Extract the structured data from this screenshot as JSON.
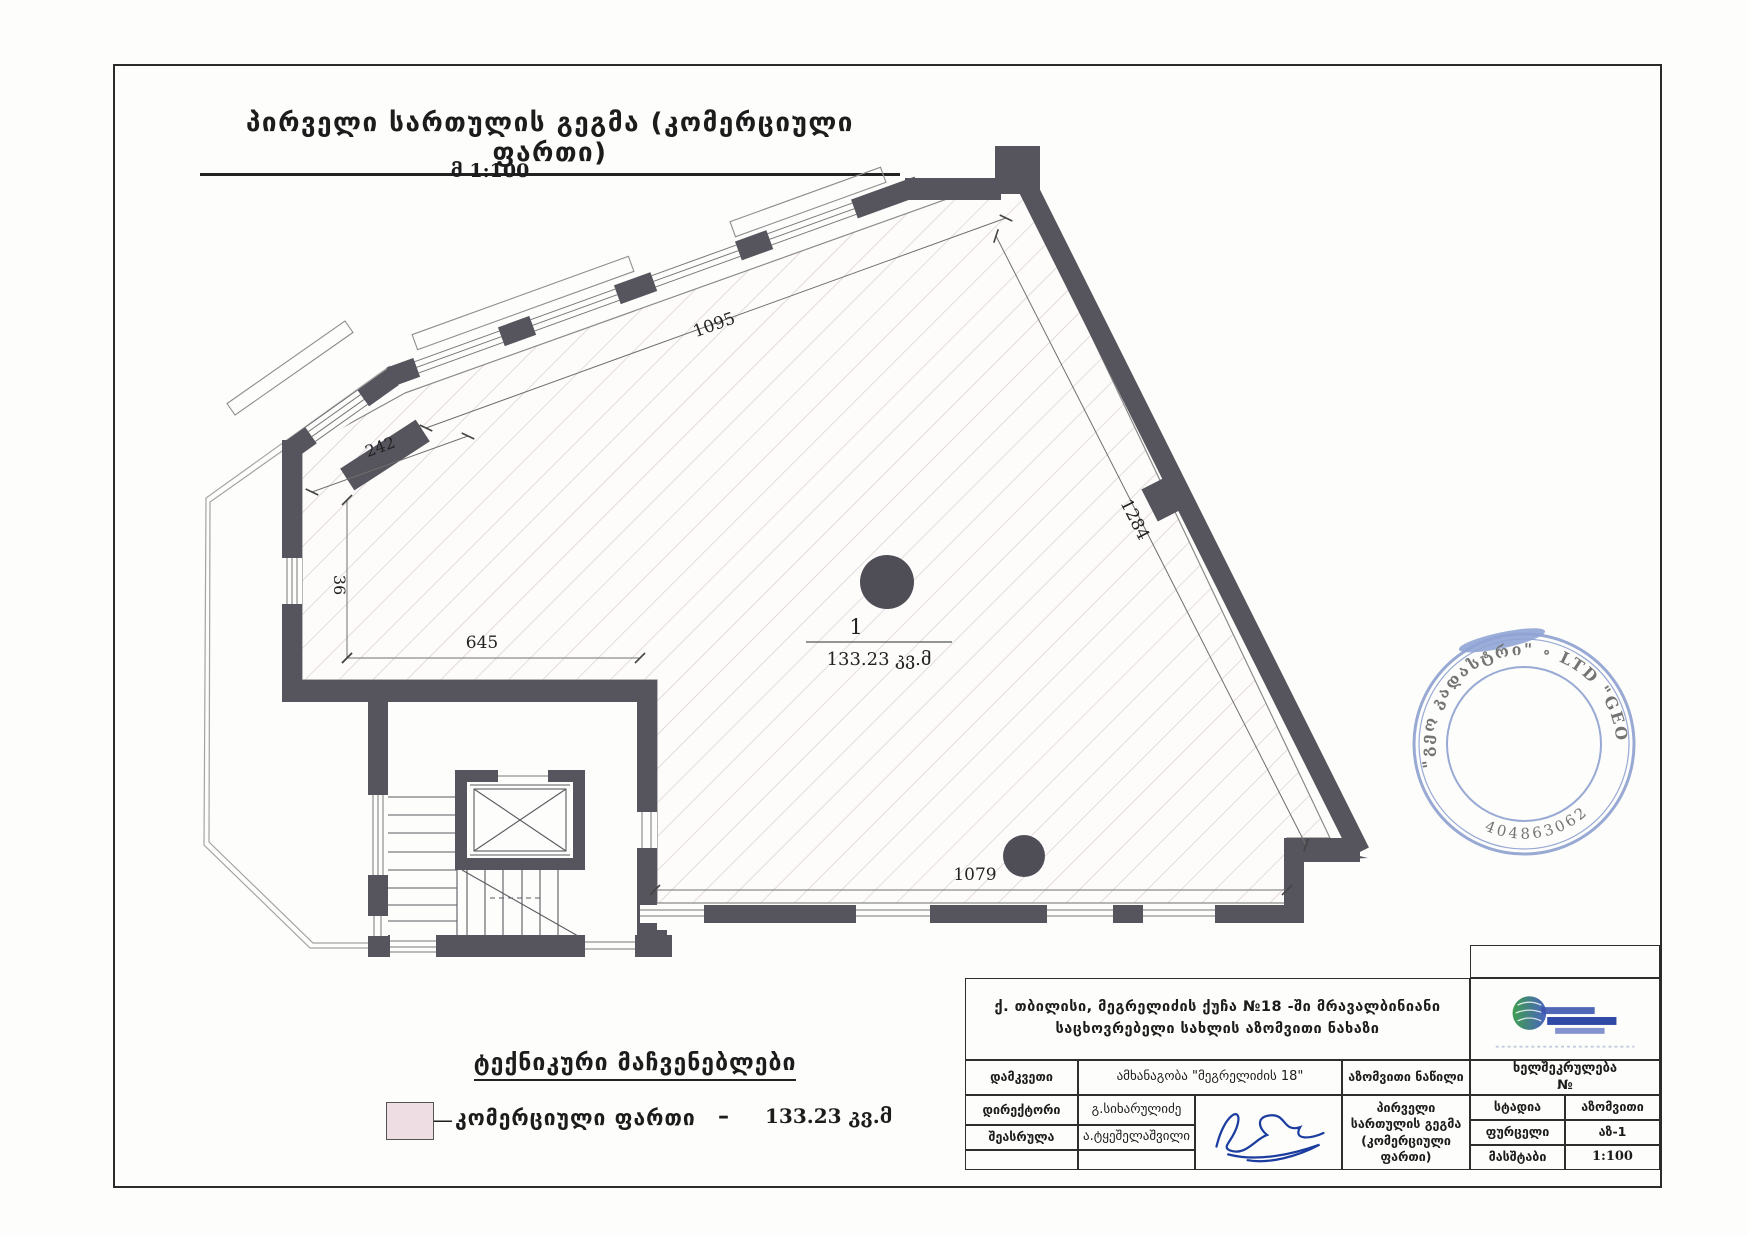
{
  "page": {
    "title": "პირველი სართულის გეგმა (კომერციული ფართი)",
    "scale_note": "მ 1:100"
  },
  "plan": {
    "room": {
      "number": "1",
      "area": "133.23 კვ.მ"
    },
    "dims": {
      "d1095": "1095",
      "d242": "242",
      "d36": "36",
      "d645": "645",
      "d1284": "1284",
      "d1079": "1079"
    },
    "wall_color": "#56555e",
    "hatch_color": "#d9c9ce"
  },
  "legend": {
    "title": "ტექნიკური მაჩვენებლები",
    "dash1": "—",
    "item_label": "კომერციული ფართი",
    "dash2": "–",
    "item_value": "133.23 კვ.მ",
    "swatch_color": "#eedde3"
  },
  "stamp": {
    "ring_text": "\"გეო კადასტრი\"  ∘  LTD \"GEO",
    "id_number": "404863062",
    "color": "#4e6cb8"
  },
  "title_block": {
    "project_title": "ქ. თბილისი, მეგრელიძის ქუჩა №18 -ში მრავალბინიანი საცხოვრებელი სახლის აზომვითი ნახაზი",
    "client_label": "დამკვეთი",
    "client_value": "ამხანაგობა \"მეგრელიძის 18\"",
    "right_header": "აზომვითი ნაწილი",
    "director_label": "დირექტორი",
    "director_value": "გ.სიხარულიძე",
    "author_label": "შეასრულა",
    "author_value": "ა.ტყეშელაშვილი",
    "sheet_title": "პირველი სართულის გეგმა (კომერციული ფართი)",
    "contract_label": "ხელშეკრულება",
    "contract_no": "№",
    "stage_label": "სტადია",
    "stage_value": "აზომვითი",
    "list_label": "ფურცელი",
    "list_value": "აზ-1",
    "scale_label": "მასშტაბი",
    "scale_value": "1:100"
  }
}
